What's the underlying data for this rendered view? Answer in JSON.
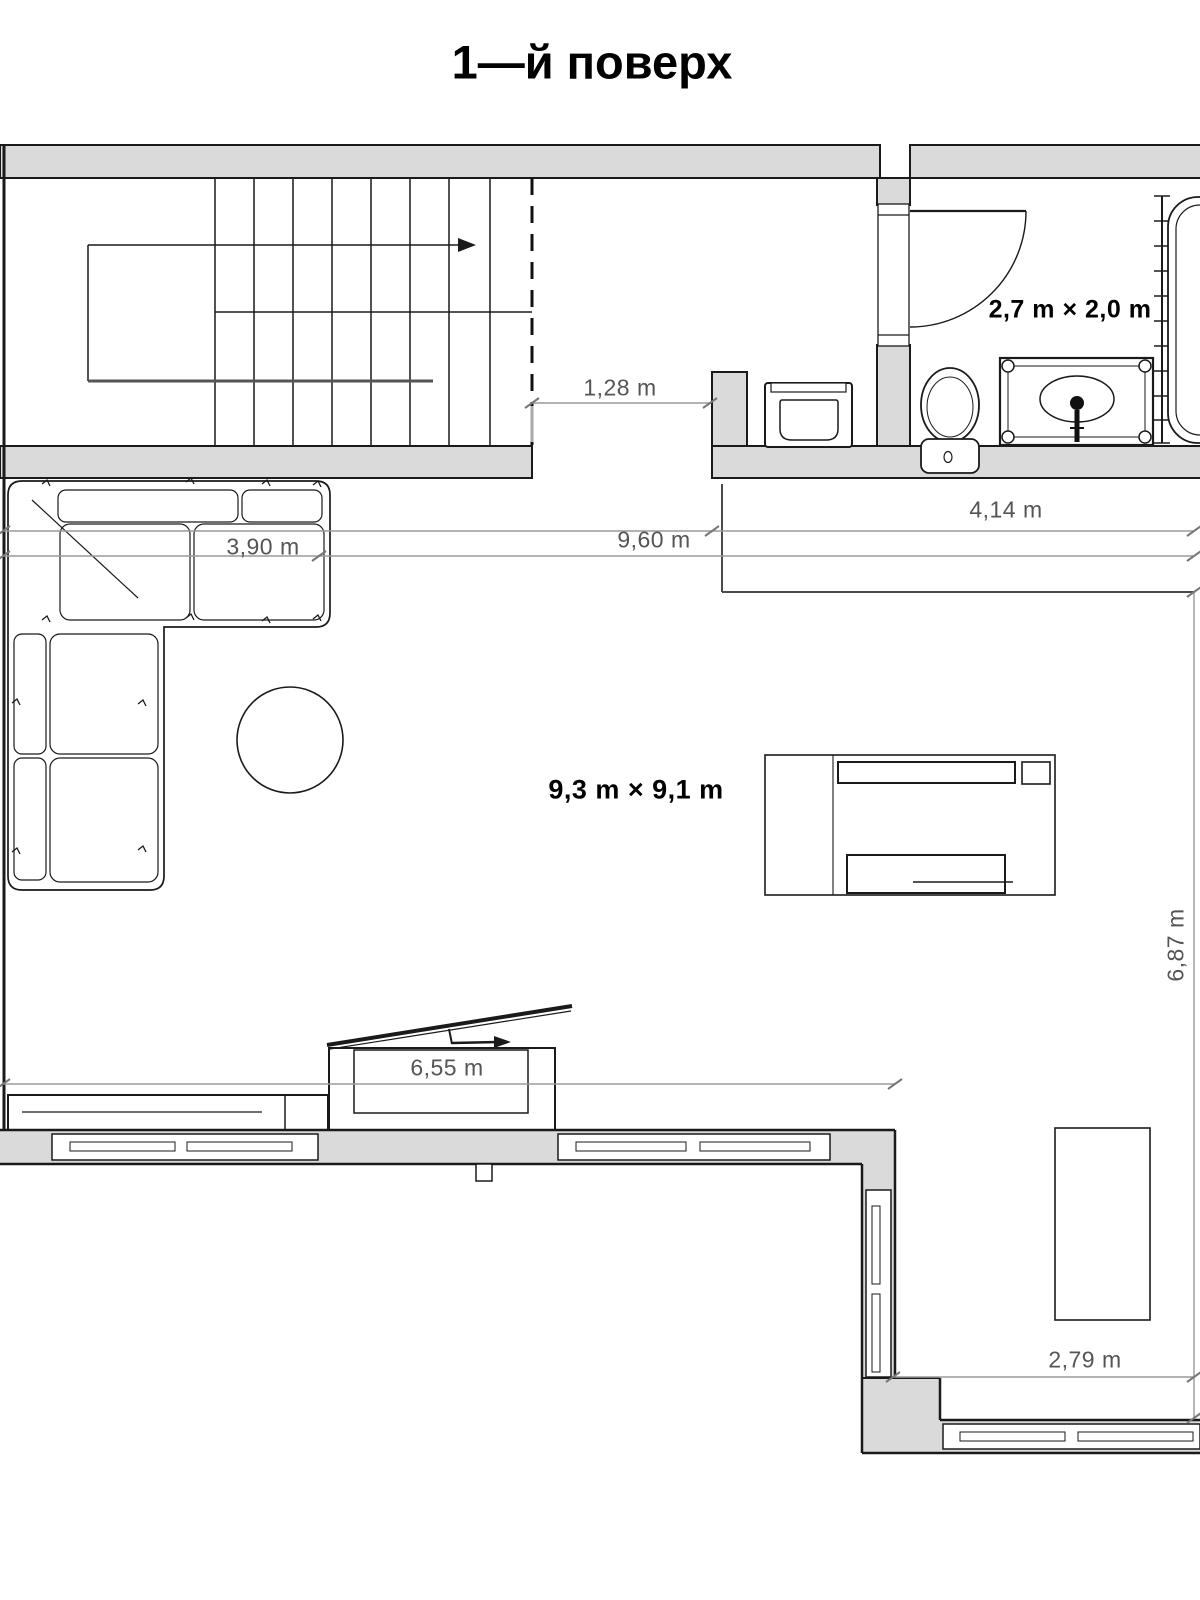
{
  "title": "1—й поверх",
  "floor_plan": {
    "room_labels": {
      "bathroom_size": "2,7 m × 2,0 m",
      "living_room_size": "9,3 m × 9,1 m"
    },
    "dimensions": [
      {
        "id": "stair-opening",
        "text": "1,28 m"
      },
      {
        "id": "sofa-length",
        "text": "3,90 m"
      },
      {
        "id": "total-width",
        "text": "9,60 m"
      },
      {
        "id": "bathroom-wall",
        "text": "4,14 m"
      },
      {
        "id": "room-depth",
        "text": "6,87 m"
      },
      {
        "id": "window-wall",
        "text": "6,55 m"
      },
      {
        "id": "right-wall",
        "text": "2,79 m"
      }
    ],
    "colors": {
      "wall_fill": "#dadada",
      "line": "#1a1a1a",
      "dim_line": "#9a9a9a",
      "dim_text": "#555555"
    }
  }
}
